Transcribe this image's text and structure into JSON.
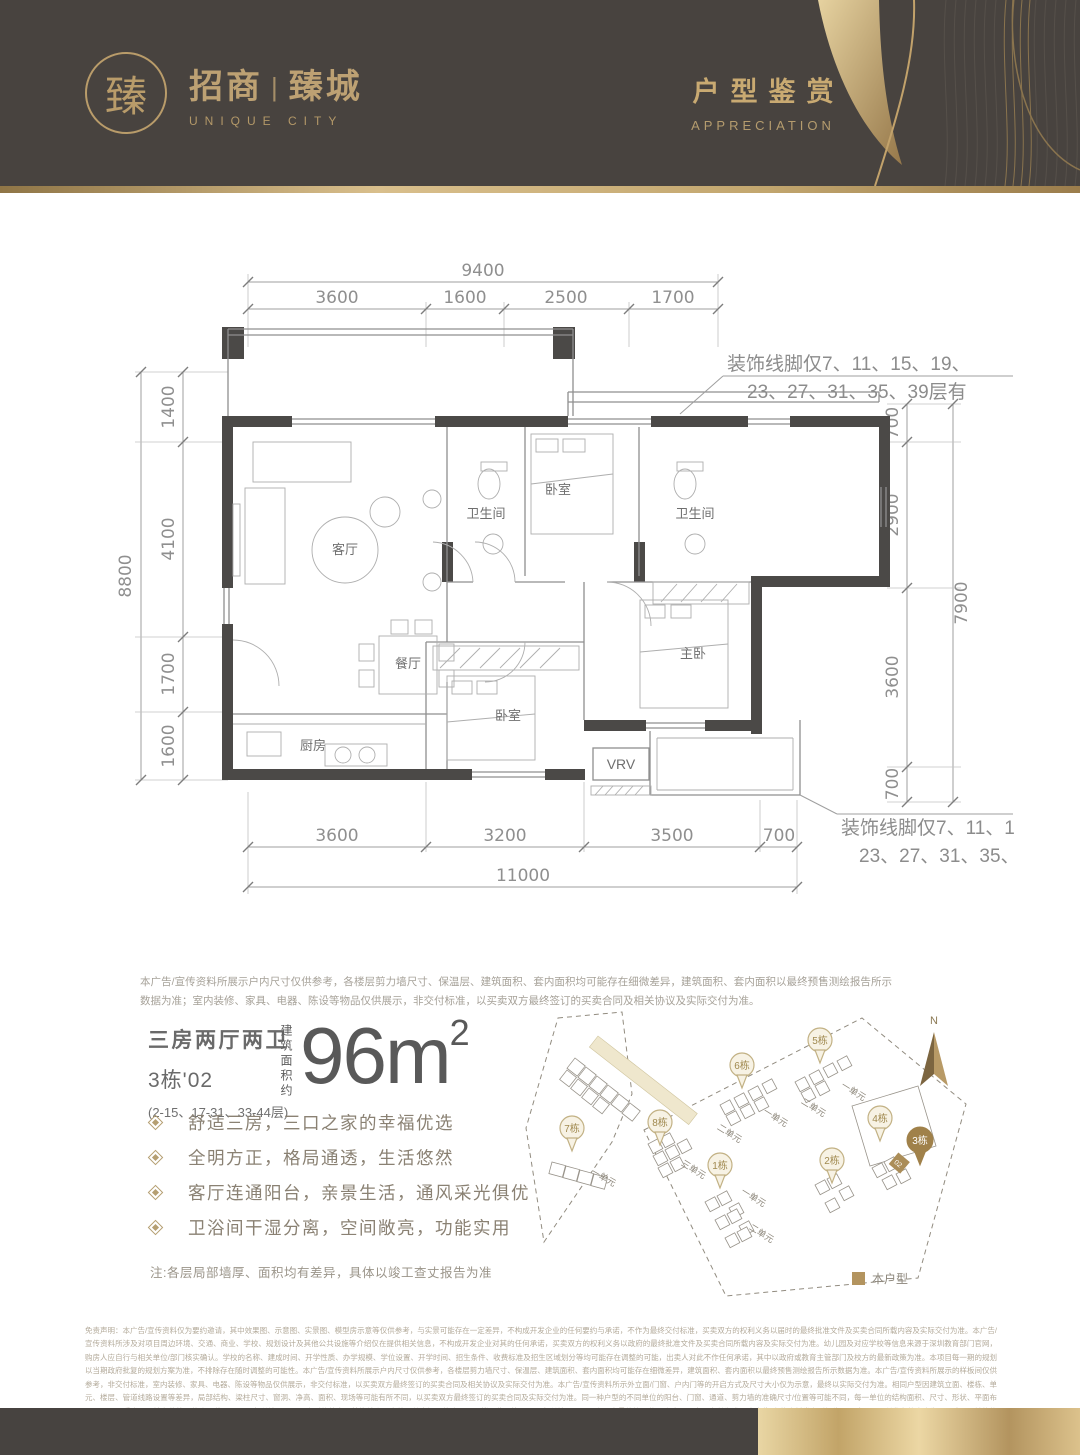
{
  "header": {
    "seal_char": "臻",
    "brand_left": "招商",
    "brand_divider": "|",
    "brand_right": "臻城",
    "brand_sub": "UNIQUE CITY",
    "title_cn": "户型鉴赏",
    "title_en": "APPRECIATION"
  },
  "floorplan": {
    "dim_top_total": "9400",
    "dim_top_segs": [
      "3600",
      "1600",
      "2500",
      "1700"
    ],
    "dim_left_total": "8800",
    "dim_left_segs": [
      "1400",
      "4100",
      "1700",
      "1600"
    ],
    "dim_right_segs": [
      "700",
      "2900",
      "3600",
      "700"
    ],
    "dim_right_total": "7900",
    "dim_bottom_segs": [
      "3600",
      "3200",
      "3500",
      "700"
    ],
    "dim_bottom_total": "11000",
    "rooms": {
      "living": "客厅",
      "dining": "餐厅",
      "kitchen": "厨房",
      "bath1": "卫生间",
      "bath2": "卫生间",
      "bedroom1": "卧室",
      "bedroom2": "卧室",
      "master": "主卧",
      "vrv": "VRV"
    },
    "molding_note_line1": "装饰线脚仅7、11、15、19、",
    "molding_note_line2": "23、27、31、35、39层有"
  },
  "info": {
    "plan_disclaimer": "本广告/宣传资料所展示户内尺寸仅供参考，各楼层剪力墙尺寸、保温层、建筑面积、套内面积均可能存在细微差异，建筑面积、套内面积以最终预售测绘报告所示数据为准；室内装修、家具、电器、陈设等物品仅供展示，非交付标准，以买卖双方最终签订的买卖合同及相关协议及实际交付为准。",
    "unit_type": "三房两厅两卫",
    "unit_no": "3栋'02",
    "floors": "(2-15、17-31、33-44层)",
    "area_label": "建筑面积约",
    "area_num": "96m",
    "area_sup": "2",
    "features": [
      "舒适三房，三口之家的幸福优选",
      "全明方正，格局通透，生活悠然",
      "客厅连通阳台，亲景生活，通风采光俱优",
      "卫浴间干湿分离，空间敞亮，功能实用"
    ],
    "note": "注:各层局部墙厚、面积均有差异，具体以竣工查丈报告为准"
  },
  "siteplan": {
    "north": "N",
    "pins": {
      "p7": "7栋",
      "p8": "8栋",
      "p6": "6栋",
      "p5": "5栋",
      "p1": "1栋",
      "p2": "2栋",
      "p4": "4栋",
      "p3": "3栋"
    },
    "units": {
      "u7": "一单元",
      "u8": "三单元",
      "u6a": "二单元",
      "u6b": "一单元",
      "u5a": "二单元",
      "u5b": "一单元",
      "u1a": "一单元",
      "u1b": "二单元"
    },
    "highlight_unit": "02",
    "legend": "本户型"
  },
  "footer": {
    "legal": "免责声明：本广告/宣传资料仅为要约邀请，其中效果图、示意图、实景图、模型房示意等仅供参考，与实景可能存在一定差异，不构成开发企业的任何要约与承诺，不作为最终交付标准，买卖双方的权利义务以届时的最终批准文件及买卖合同所载内容及实际交付为准。本广告/宣传资料所涉及对项目周边环境、交通、商业、学校、规划设计及其他公共设施等介绍仅在提供相关信息，不构成开发企业对其的任何承诺，买卖双方的权利义务以政府的最终批准文件及买卖合同所载内容及实际交付为准。幼儿园及对应学校等信息来源于深圳教育部门官网，购房人应自行与相关单位/部门核实确认。学校的名称、建成时间、开学性质、办学规模、学位设置、开学时间、招生条件、收费标准及招生区域划分等均可能存在调整的可能，出卖人对此不作任何承诺，其中以政府或教育主管部门及校方的最新政策为准。本项目每一期的规划以当期政府批复的规划方案为准，不排除存在随时调整的可能性。本广告/宣传资料所展示户内尺寸仅供参考，各楼层剪力墙尺寸、保温层、建筑面积、套内面积均可能存在细微差异，建筑面积、套内面积以最终预售测绘报告所示数据为准。本广告/宣传资料所展示的样板间仅供参考，非交付标准，室内装修、家具、电器、陈设等物品仅供展示，非交付标准，以买卖双方最终签订的买卖合同及相关协议及实际交付为准。本广告/宣传资料所示外立面/门窗、户内门等的开启方式及尺寸大小仅为示意，最终以实际交付为准。相同户型因建筑立面、楼栋、单元、楼层、管道线路设置等差异，局部结构、梁柱尺寸、窗洞、净高、面积、现场等可能有所不同，以买卖双方最终签订的买卖合同及实际交付为准。同一种户型的不同单位的阳台、门窗、通道、剪力墙的准确尺寸/位置等可能不同，每一单位的结构面积、尺寸、形状、平面布局、通风、采光、环境条件等可能会因位置不同而有所差异。同一户型的外立面装饰线脚、室外公共空间可能会因不同楼层位置等不同而有所差异，以买卖双方最终签订的买卖合同及实际交付为准。本广告/宣传资料发布时间为2023年8月，所发布的内容为2023年8月前的信息，后续如有更新调整参考最新版本，敬请留意最新资料。本广告/宣传资料修改权和最终解释权归【招商局置业经营发展有限公司】所有。本项目备案名：【招商臻城花园】（推广名：【招商臻城】）。本项目开发企业：【深圳招商宅业投资发展有限公司】，预售许可证号：【深房许字（2023）龙岗006号】，制作日期：2023年8月【广告】"
  }
}
